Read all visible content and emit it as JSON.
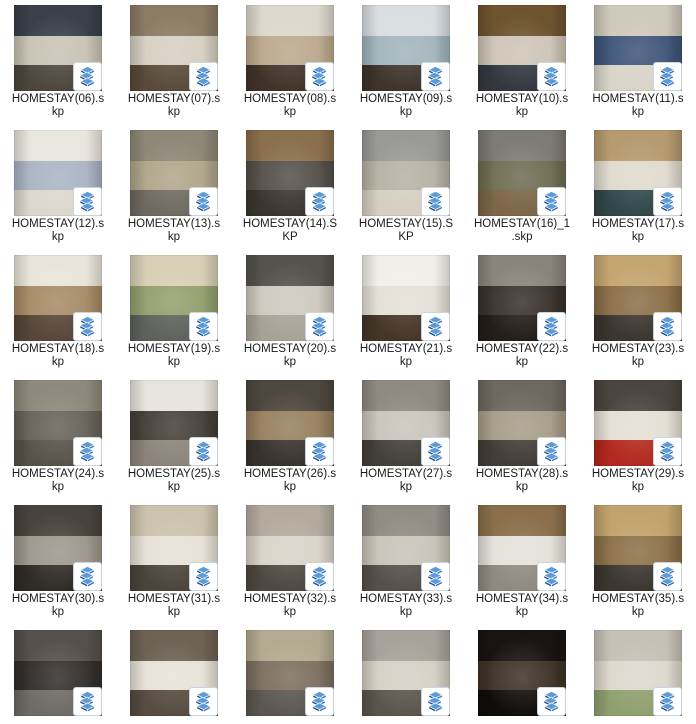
{
  "view": {
    "description": "File manager large-icon view showing SketchUp homestay interior model files",
    "columns": 6,
    "rows_visible": 6
  },
  "colors": {
    "background": "#ffffff",
    "label_text": "#1a1a1a",
    "badge_bg": "#ffffff",
    "badge_border": "#c9d4dc",
    "logo_blue_light": "#5b9bd9",
    "logo_blue_mid": "#2f6eb5",
    "logo_blue_dark": "#1a4a85"
  },
  "badge_icon": "sketchup-logo",
  "files": [
    {
      "name": "HOMESTAY(06).skp",
      "label_lines": [
        "HOMESTAY(06).s",
        "kp"
      ],
      "thumb": {
        "c1": "#3a4049",
        "c2": "#c8c3b4",
        "c3": "#4e463c"
      }
    },
    {
      "name": "HOMESTAY(07).skp",
      "label_lines": [
        "HOMESTAY(07).s",
        "kp"
      ],
      "thumb": {
        "c1": "#8c7c66",
        "c2": "#d6d0c2",
        "c3": "#5a4a3a"
      }
    },
    {
      "name": "HOMESTAY(08).skp",
      "label_lines": [
        "HOMESTAY(08).s",
        "kp"
      ],
      "thumb": {
        "c1": "#ddd8cc",
        "c2": "#bba98c",
        "c3": "#42332a"
      }
    },
    {
      "name": "HOMESTAY(09).skp",
      "label_lines": [
        "HOMESTAY(09).s",
        "kp"
      ],
      "thumb": {
        "c1": "#d9dee1",
        "c2": "#a3b5bd",
        "c3": "#3e342c"
      }
    },
    {
      "name": "HOMESTAY(10).skp",
      "label_lines": [
        "HOMESTAY(10).s",
        "kp"
      ],
      "thumb": {
        "c1": "#6e532f",
        "c2": "#cdc5b6",
        "c3": "#33373f"
      }
    },
    {
      "name": "HOMESTAY(11).skp",
      "label_lines": [
        "HOMESTAY(11).s",
        "kp"
      ],
      "thumb": {
        "c1": "#cfc9bb",
        "c2": "#3f567a",
        "c3": "#d9d4c8"
      }
    },
    {
      "name": "HOMESTAY(12).skp",
      "label_lines": [
        "HOMESTAY(12).s",
        "kp"
      ],
      "thumb": {
        "c1": "#e9e6de",
        "c2": "#aab4c4",
        "c3": "#dcd8ce"
      }
    },
    {
      "name": "HOMESTAY(13).skp",
      "label_lines": [
        "HOMESTAY(13).s",
        "kp"
      ],
      "thumb": {
        "c1": "#8e8878",
        "c2": "#b1a68a",
        "c3": "#6e6a60"
      }
    },
    {
      "name": "HOMESTAY(14).SKP",
      "label_lines": [
        "HOMESTAY(14).S",
        "KP"
      ],
      "thumb": {
        "c1": "#8a6f4d",
        "c2": "#55504a",
        "c3": "#3a362f"
      }
    },
    {
      "name": "HOMESTAY(15).SKP",
      "label_lines": [
        "HOMESTAY(15).S",
        "KP"
      ],
      "thumb": {
        "c1": "#9a9a98",
        "c2": "#b8b2a4",
        "c3": "#d6cfc0"
      }
    },
    {
      "name": "HOMESTAY(16)_1.skp",
      "label_lines": [
        "HOMESTAY(16)_1",
        ".skp"
      ],
      "thumb": {
        "c1": "#7e7b76",
        "c2": "#6f6d52",
        "c3": "#7c6548"
      }
    },
    {
      "name": "HOMESTAY(17).skp",
      "label_lines": [
        "HOMESTAY(17).s",
        "kp"
      ],
      "thumb": {
        "c1": "#b79a6f",
        "c2": "#e0dacd",
        "c3": "#31474a"
      }
    },
    {
      "name": "HOMESTAY(18).skp",
      "label_lines": [
        "HOMESTAY(18).s",
        "kp"
      ],
      "thumb": {
        "c1": "#e9e5da",
        "c2": "#a78b66",
        "c3": "#574639"
      }
    },
    {
      "name": "HOMESTAY(19).skp",
      "label_lines": [
        "HOMESTAY(19).s",
        "kp"
      ],
      "thumb": {
        "c1": "#d9cfb6",
        "c2": "#94a06e",
        "c3": "#5f625c"
      }
    },
    {
      "name": "HOMESTAY(20).skp",
      "label_lines": [
        "HOMESTAY(20).s",
        "kp"
      ],
      "thumb": {
        "c1": "#55534e",
        "c2": "#cdc9be",
        "c3": "#a8a296"
      }
    },
    {
      "name": "HOMESTAY(21).skp",
      "label_lines": [
        "HOMESTAY(21).s",
        "kp"
      ],
      "thumb": {
        "c1": "#f1efe9",
        "c2": "#e4e0d7",
        "c3": "#453527"
      }
    },
    {
      "name": "HOMESTAY(22).skp",
      "label_lines": [
        "HOMESTAY(22).s",
        "kp"
      ],
      "thumb": {
        "c1": "#8a857c",
        "c2": "#3a332c",
        "c3": "#241d18"
      }
    },
    {
      "name": "HOMESTAY(23).skp",
      "label_lines": [
        "HOMESTAY(23).s",
        "kp"
      ],
      "thumb": {
        "c1": "#c5a671",
        "c2": "#8b6f49",
        "c3": "#3b3530"
      }
    },
    {
      "name": "HOMESTAY(24).skp",
      "label_lines": [
        "HOMESTAY(24).s",
        "kp"
      ],
      "thumb": {
        "c1": "#8e897c",
        "c2": "#67635a",
        "c3": "#575349"
      }
    },
    {
      "name": "HOMESTAY(25).skp",
      "label_lines": [
        "HOMESTAY(25).s",
        "kp"
      ],
      "thumb": {
        "c1": "#e7e4dd",
        "c2": "#46403a",
        "c3": "#8b847a"
      }
    },
    {
      "name": "HOMESTAY(26).skp",
      "label_lines": [
        "HOMESTAY(26).s",
        "kp"
      ],
      "thumb": {
        "c1": "#4d473f",
        "c2": "#97805f",
        "c3": "#38332d"
      }
    },
    {
      "name": "HOMESTAY(27).skp",
      "label_lines": [
        "HOMESTAY(27).s",
        "kp"
      ],
      "thumb": {
        "c1": "#8f8a80",
        "c2": "#cac5bb",
        "c3": "#44403a"
      }
    },
    {
      "name": "HOMESTAY(28).skp",
      "label_lines": [
        "HOMESTAY(28).s",
        "kp"
      ],
      "thumb": {
        "c1": "#6e685f",
        "c2": "#a89d8a",
        "c3": "#423d37"
      }
    },
    {
      "name": "HOMESTAY(29).skp",
      "label_lines": [
        "HOMESTAY(29).s",
        "kp"
      ],
      "thumb": {
        "c1": "#4b453f",
        "c2": "#e4dfd3",
        "c3": "#b3281e"
      }
    },
    {
      "name": "HOMESTAY(30).skp",
      "label_lines": [
        "HOMESTAY(30).s",
        "kp"
      ],
      "thumb": {
        "c1": "#48443d",
        "c2": "#9d978c",
        "c3": "#2f2c28"
      }
    },
    {
      "name": "HOMESTAY(31).skp",
      "label_lines": [
        "HOMESTAY(31).s",
        "kp"
      ],
      "thumb": {
        "c1": "#cdc3ac",
        "c2": "#e6e1d6",
        "c3": "#4b443b"
      }
    },
    {
      "name": "HOMESTAY(32).skp",
      "label_lines": [
        "HOMESTAY(32).s",
        "kp"
      ],
      "thumb": {
        "c1": "#b2ab9d",
        "c2": "#d9d3c7",
        "c3": "#4e4840"
      }
    },
    {
      "name": "HOMESTAY(33).skp",
      "label_lines": [
        "HOMESTAY(33).s",
        "kp"
      ],
      "thumb": {
        "c1": "#918d85",
        "c2": "#c9c4b8",
        "c3": "#55514a"
      }
    },
    {
      "name": "HOMESTAY(34).skp",
      "label_lines": [
        "HOMESTAY(34).s",
        "kp"
      ],
      "thumb": {
        "c1": "#8a6f4a",
        "c2": "#e4e1d9",
        "c3": "#8f8a80"
      }
    },
    {
      "name": "HOMESTAY(35).skp",
      "label_lines": [
        "HOMESTAY(35).s",
        "kp"
      ],
      "thumb": {
        "c1": "#c2a36b",
        "c2": "#8c7149",
        "c3": "#3b3630"
      }
    },
    {
      "name": "",
      "label_lines": [],
      "thumb": {
        "c1": "#55504b",
        "c2": "#332f2c",
        "c3": "#6e6a64"
      }
    },
    {
      "name": "",
      "label_lines": [],
      "thumb": {
        "c1": "#6e6254",
        "c2": "#e6e2d7",
        "c3": "#564c40"
      }
    },
    {
      "name": "",
      "label_lines": [],
      "thumb": {
        "c1": "#b4aa91",
        "c2": "#7d6f60",
        "c3": "#5b5750"
      }
    },
    {
      "name": "",
      "label_lines": [],
      "thumb": {
        "c1": "#a8a29a",
        "c2": "#d6d0c4",
        "c3": "#5b554b"
      }
    },
    {
      "name": "",
      "label_lines": [],
      "thumb": {
        "c1": "#191411",
        "c2": "#3f3328",
        "c3": "#100d0b"
      }
    },
    {
      "name": "",
      "label_lines": [],
      "thumb": {
        "c1": "#c6c1b5",
        "c2": "#dcd8cc",
        "c3": "#8fa06f"
      }
    }
  ]
}
